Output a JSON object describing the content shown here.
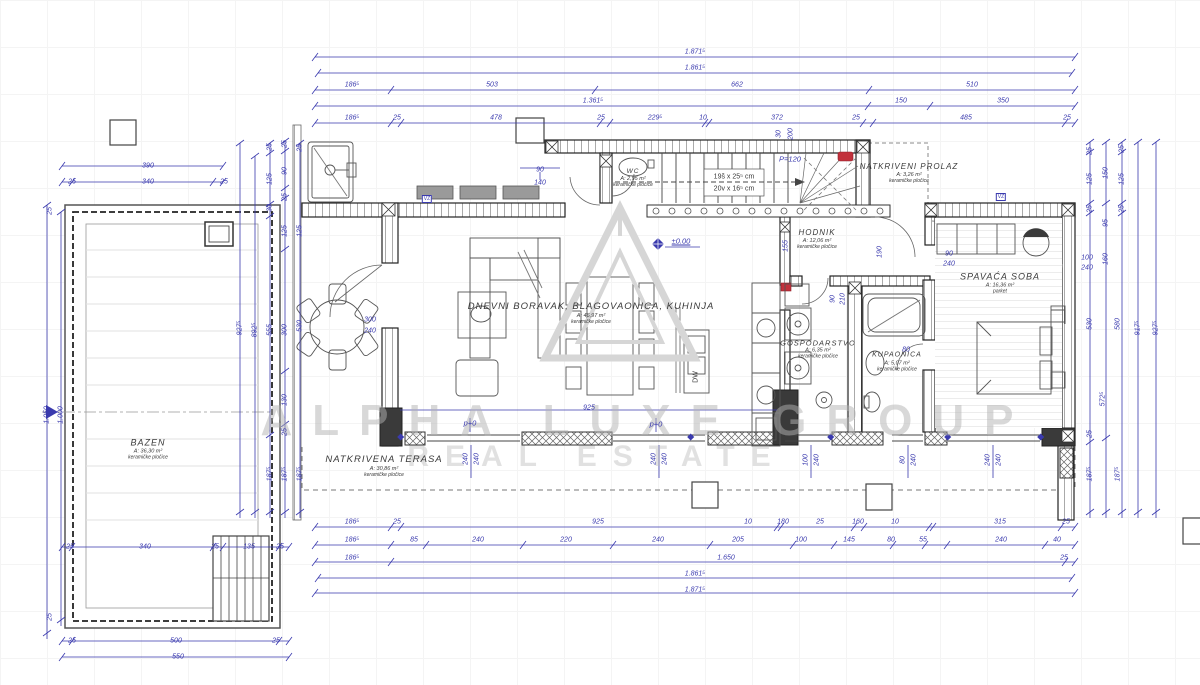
{
  "watermark": {
    "line1": "ALPHA LUXE GROUP",
    "line2": "REAL ESTATE"
  },
  "rooms": [
    {
      "name": "BAZEN",
      "area": "A: 36,30 m²",
      "floor": "keramičke pločice",
      "x": 148,
      "y": 449,
      "fs": 9
    },
    {
      "name": "NATKRIVENA TERASA",
      "area": "A: 30,86 m²",
      "floor": "keramičke pločice",
      "x": 384,
      "y": 466,
      "fs": 9.5
    },
    {
      "name": "DNEVNI BORAVAK, BLAGOVAONICA, KUHINJA",
      "area": "A: 46,97 m²",
      "floor": "keramičke pločice",
      "x": 591,
      "y": 313,
      "fs": 9.5
    },
    {
      "name": "WC",
      "area": "A: 2,95 m²",
      "floor": "keramičke pločice",
      "x": 633,
      "y": 178,
      "fs": 6.5
    },
    {
      "name": "HODNIK",
      "area": "A: 12,06 m²",
      "floor": "keramičke pločice",
      "x": 817,
      "y": 239,
      "fs": 8
    },
    {
      "name": "NATKRIVENI PROLAZ",
      "area": "A: 3,26 m²",
      "floor": "keramičke pločice",
      "x": 909,
      "y": 173,
      "fs": 8
    },
    {
      "name": "SPAVAĆA SOBA",
      "area": "A: 16,36 m²",
      "floor": "parket",
      "x": 1000,
      "y": 283,
      "fs": 9
    },
    {
      "name": "GOSPODARSTVO",
      "area": "A: 6,35 m²",
      "floor": "keramičke pločice",
      "x": 818,
      "y": 349,
      "fs": 7.5
    },
    {
      "name": "KUPAONICA",
      "area": "A: 5,07 m²",
      "floor": "keramičke pločice",
      "x": 897,
      "y": 362,
      "fs": 7
    }
  ],
  "dims": [
    {
      "t": "1.871⁵",
      "x": 695,
      "y": 52
    },
    {
      "t": "1.861⁵",
      "x": 695,
      "y": 68
    },
    {
      "t": "186⁵",
      "x": 352,
      "y": 85
    },
    {
      "t": "503",
      "x": 492,
      "y": 85
    },
    {
      "t": "662",
      "x": 737,
      "y": 85
    },
    {
      "t": "510",
      "x": 972,
      "y": 85
    },
    {
      "t": "1.361⁵",
      "x": 593,
      "y": 101
    },
    {
      "t": "150",
      "x": 901,
      "y": 101
    },
    {
      "t": "350",
      "x": 1003,
      "y": 101
    },
    {
      "t": "186⁵",
      "x": 352,
      "y": 118
    },
    {
      "t": "25",
      "x": 397,
      "y": 118
    },
    {
      "t": "478",
      "x": 496,
      "y": 118
    },
    {
      "t": "25",
      "x": 601,
      "y": 118
    },
    {
      "t": "229⁵",
      "x": 655,
      "y": 118
    },
    {
      "t": "10",
      "x": 703,
      "y": 118
    },
    {
      "t": "372",
      "x": 777,
      "y": 118
    },
    {
      "t": "25",
      "x": 856,
      "y": 118
    },
    {
      "t": "485",
      "x": 966,
      "y": 118
    },
    {
      "t": "25",
      "x": 1067,
      "y": 118
    },
    {
      "t": "30",
      "x": 779,
      "y": 134,
      "r": -90
    },
    {
      "t": "200",
      "x": 791,
      "y": 134,
      "r": -90
    },
    {
      "t": "186⁵",
      "x": 352,
      "y": 522
    },
    {
      "t": "25",
      "x": 397,
      "y": 522
    },
    {
      "t": "925",
      "x": 598,
      "y": 522
    },
    {
      "t": "10",
      "x": 748,
      "y": 522
    },
    {
      "t": "180",
      "x": 783,
      "y": 522
    },
    {
      "t": "25",
      "x": 820,
      "y": 522
    },
    {
      "t": "160",
      "x": 858,
      "y": 522
    },
    {
      "t": "10",
      "x": 895,
      "y": 522
    },
    {
      "t": "315",
      "x": 1000,
      "y": 522
    },
    {
      "t": "25",
      "x": 1066,
      "y": 522
    },
    {
      "t": "186⁵",
      "x": 352,
      "y": 540
    },
    {
      "t": "85",
      "x": 414,
      "y": 540
    },
    {
      "t": "240",
      "x": 478,
      "y": 540
    },
    {
      "t": "220",
      "x": 566,
      "y": 540
    },
    {
      "t": "240",
      "x": 658,
      "y": 540
    },
    {
      "t": "205",
      "x": 738,
      "y": 540
    },
    {
      "t": "100",
      "x": 801,
      "y": 540
    },
    {
      "t": "145",
      "x": 849,
      "y": 540
    },
    {
      "t": "80",
      "x": 891,
      "y": 540
    },
    {
      "t": "55",
      "x": 923,
      "y": 540
    },
    {
      "t": "240",
      "x": 1001,
      "y": 540
    },
    {
      "t": "40",
      "x": 1057,
      "y": 540
    },
    {
      "t": "186⁵",
      "x": 352,
      "y": 558
    },
    {
      "t": "1.650",
      "x": 726,
      "y": 558
    },
    {
      "t": "25",
      "x": 1064,
      "y": 558
    },
    {
      "t": "1.861⁵",
      "x": 695,
      "y": 574
    },
    {
      "t": "1.871⁵",
      "x": 695,
      "y": 590
    },
    {
      "t": "390",
      "x": 148,
      "y": 166
    },
    {
      "t": "25",
      "x": 72,
      "y": 182
    },
    {
      "t": "340",
      "x": 148,
      "y": 182
    },
    {
      "t": "25",
      "x": 224,
      "y": 182
    },
    {
      "t": "1.050",
      "x": 47,
      "y": 415,
      "r": -90
    },
    {
      "t": "1.000",
      "x": 61,
      "y": 415,
      "r": -90
    },
    {
      "t": "25",
      "x": 50,
      "y": 211,
      "r": -90
    },
    {
      "t": "25",
      "x": 50,
      "y": 617,
      "r": -90
    },
    {
      "t": "25",
      "x": 70,
      "y": 547
    },
    {
      "t": "340",
      "x": 145,
      "y": 547
    },
    {
      "t": "25",
      "x": 215,
      "y": 547
    },
    {
      "t": "135",
      "x": 249,
      "y": 547
    },
    {
      "t": "25",
      "x": 280,
      "y": 547
    },
    {
      "t": "25",
      "x": 72,
      "y": 641
    },
    {
      "t": "500",
      "x": 176,
      "y": 641
    },
    {
      "t": "25",
      "x": 276,
      "y": 641
    },
    {
      "t": "550",
      "x": 178,
      "y": 657
    },
    {
      "t": "927⁵",
      "x": 240,
      "y": 328,
      "r": -90
    },
    {
      "t": "892⁵",
      "x": 255,
      "y": 330,
      "r": -90
    },
    {
      "t": "25",
      "x": 270,
      "y": 147,
      "r": -90
    },
    {
      "t": "125",
      "x": 270,
      "y": 179,
      "r": -90
    },
    {
      "t": "30",
      "x": 270,
      "y": 208,
      "r": -90
    },
    {
      "t": "555",
      "x": 270,
      "y": 330,
      "r": -90
    },
    {
      "t": "187⁵",
      "x": 270,
      "y": 474,
      "r": -90
    },
    {
      "t": "25",
      "x": 285,
      "y": 144,
      "r": -90
    },
    {
      "t": "90",
      "x": 285,
      "y": 171,
      "r": -90
    },
    {
      "t": "25",
      "x": 285,
      "y": 197,
      "r": -90
    },
    {
      "t": "125",
      "x": 285,
      "y": 231,
      "r": -90
    },
    {
      "t": "300",
      "x": 285,
      "y": 330,
      "r": -90
    },
    {
      "t": "130",
      "x": 285,
      "y": 400,
      "r": -90
    },
    {
      "t": "25",
      "x": 285,
      "y": 432,
      "r": -90
    },
    {
      "t": "187⁵",
      "x": 285,
      "y": 474,
      "r": -90
    },
    {
      "t": "25",
      "x": 300,
      "y": 148,
      "r": -90
    },
    {
      "t": "125",
      "x": 300,
      "y": 231,
      "r": -90
    },
    {
      "t": "530",
      "x": 300,
      "y": 326,
      "r": -90
    },
    {
      "t": "187⁵",
      "x": 300,
      "y": 474,
      "r": -90
    },
    {
      "t": "25",
      "x": 1090,
      "y": 151,
      "r": -90
    },
    {
      "t": "125",
      "x": 1090,
      "y": 179,
      "r": -90
    },
    {
      "t": "25",
      "x": 1090,
      "y": 209,
      "r": -90
    },
    {
      "t": "530",
      "x": 1090,
      "y": 324,
      "r": -90
    },
    {
      "t": "25",
      "x": 1090,
      "y": 434,
      "r": -90
    },
    {
      "t": "187⁵",
      "x": 1090,
      "y": 474,
      "r": -90
    },
    {
      "t": "150",
      "x": 1106,
      "y": 173,
      "r": -90
    },
    {
      "t": "95",
      "x": 1106,
      "y": 223,
      "r": -90
    },
    {
      "t": "160",
      "x": 1106,
      "y": 259,
      "r": -90
    },
    {
      "t": "580",
      "x": 1118,
      "y": 324,
      "r": -90
    },
    {
      "t": "187⁵",
      "x": 1118,
      "y": 474,
      "r": -90
    },
    {
      "t": "572⁵",
      "x": 1103,
      "y": 399,
      "r": -90
    },
    {
      "t": "25",
      "x": 1122,
      "y": 149,
      "r": -90
    },
    {
      "t": "125",
      "x": 1122,
      "y": 179,
      "r": -90
    },
    {
      "t": "25",
      "x": 1122,
      "y": 209,
      "r": -90
    },
    {
      "t": "917⁵",
      "x": 1138,
      "y": 328,
      "r": -90
    },
    {
      "t": "927⁵",
      "x": 1156,
      "y": 328,
      "r": -90
    },
    {
      "t": "100",
      "x": 1087,
      "y": 258
    },
    {
      "t": "240",
      "x": 1087,
      "y": 268
    },
    {
      "t": "90",
      "x": 540,
      "y": 170
    },
    {
      "t": "140",
      "x": 540,
      "y": 183
    },
    {
      "t": "155",
      "x": 786,
      "y": 246,
      "r": -90
    },
    {
      "t": "190",
      "x": 880,
      "y": 252,
      "r": -90
    },
    {
      "t": "90",
      "x": 833,
      "y": 299,
      "r": -90
    },
    {
      "t": "210",
      "x": 843,
      "y": 299,
      "r": -90
    },
    {
      "t": "80",
      "x": 906,
      "y": 350
    },
    {
      "t": "300",
      "x": 370,
      "y": 320
    },
    {
      "t": "240",
      "x": 370,
      "y": 331
    },
    {
      "t": "925",
      "x": 589,
      "y": 408
    },
    {
      "t": "240",
      "x": 466,
      "y": 459,
      "r": -90
    },
    {
      "t": "240",
      "x": 477,
      "y": 459,
      "r": -90
    },
    {
      "t": "240",
      "x": 654,
      "y": 459,
      "r": -90
    },
    {
      "t": "240",
      "x": 665,
      "y": 459,
      "r": -90
    },
    {
      "t": "100",
      "x": 806,
      "y": 460,
      "r": -90
    },
    {
      "t": "240",
      "x": 817,
      "y": 460,
      "r": -90
    },
    {
      "t": "80",
      "x": 903,
      "y": 460,
      "r": -90
    },
    {
      "t": "240",
      "x": 914,
      "y": 460,
      "r": -90
    },
    {
      "t": "240",
      "x": 988,
      "y": 460,
      "r": -90
    },
    {
      "t": "240",
      "x": 999,
      "y": 460,
      "r": -90
    },
    {
      "t": "90",
      "x": 949,
      "y": 254
    },
    {
      "t": "240",
      "x": 949,
      "y": 264
    }
  ],
  "notes": [
    {
      "t": "±0.00",
      "x": 681,
      "y": 241,
      "k": "ul"
    },
    {
      "t": "p+0",
      "x": 470,
      "y": 423,
      "k": "note"
    },
    {
      "t": "p+0",
      "x": 656,
      "y": 424,
      "k": "note"
    },
    {
      "t": "P=120",
      "x": 790,
      "y": 159,
      "k": "note"
    },
    {
      "t": "VZ",
      "x": 427,
      "y": 199,
      "k": "tag"
    },
    {
      "t": "VZ",
      "x": 1001,
      "y": 197,
      "k": "tag"
    },
    {
      "t": "19š x 25⁵ cm",
      "x": 734,
      "y": 177,
      "k": "dark"
    },
    {
      "t": "20v x 16⁵ cm",
      "x": 734,
      "y": 189,
      "k": "dark"
    },
    {
      "t": "DW",
      "x": 696,
      "y": 377,
      "r": -90,
      "k": "dark"
    }
  ],
  "colors": {
    "dimension_blue": "#3a3aae",
    "wall_dark": "#2e2e2e",
    "red_accent": "#c2313c",
    "watermark_gray": "#c9c9c9"
  }
}
